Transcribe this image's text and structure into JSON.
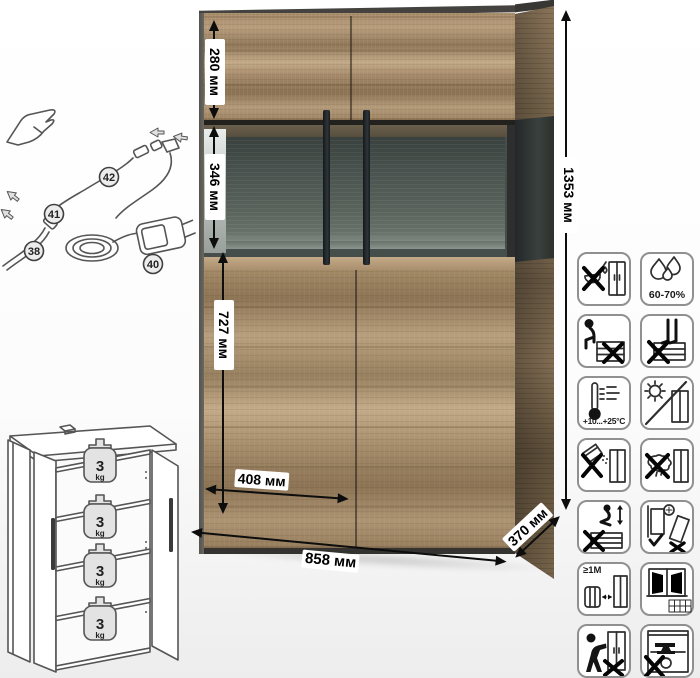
{
  "dimensions": {
    "height_total": "1353 мм",
    "upper_section": "280 мм",
    "display_section": "346 мм",
    "lower_section": "727 мм",
    "door_width": "408 мм",
    "width": "858 мм",
    "depth": "370 мм"
  },
  "led_parts": {
    "part_38": "38",
    "part_40": "40",
    "part_41": "41",
    "part_42": "42"
  },
  "shelf_load": {
    "value": "3",
    "unit": "kg"
  },
  "care_labels": {
    "humidity": "60-70%",
    "temperature": "+10...+25°C",
    "min_distance": "≥1M"
  },
  "care_icons": [
    "no-water-spill-icon",
    "humidity-60-70-icon",
    "no-sitting-icon",
    "no-standing-icon",
    "temperature-range-icon",
    "no-direct-sunlight-icon",
    "no-abrasive-cleaners-icon",
    "no-wet-cloth-icon",
    "no-jumping-icon",
    "anchor-to-wall-icon",
    "keep-1m-from-heat-icon",
    "ventilate-room-icon",
    "no-pushing-icon",
    "no-heavy-items-icon"
  ]
}
